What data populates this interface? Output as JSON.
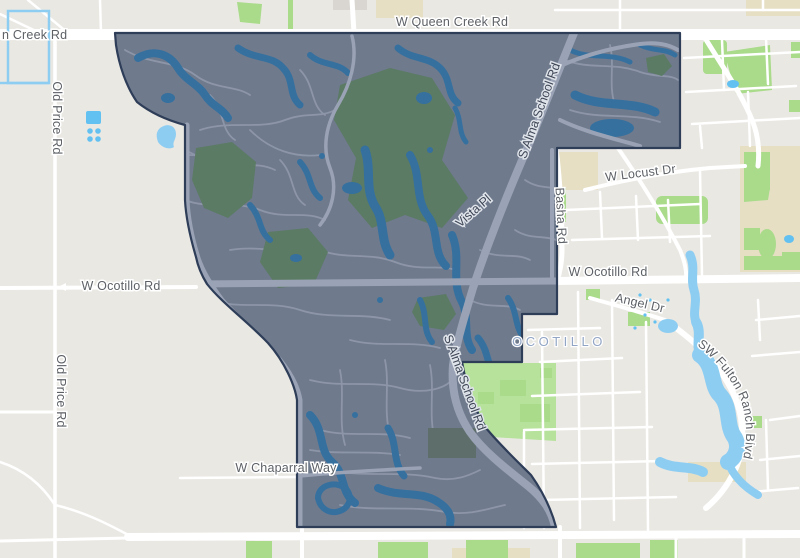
{
  "map": {
    "kind": "street-map-with-boundary-overlay",
    "district_label": "OCOTILLO",
    "road_labels": {
      "queen_creek_partial": "n Creek Rd",
      "queen_creek": "W Queen Creek Rd",
      "old_price_upper": "Old Price Rd",
      "old_price_lower": "Old Price Rd",
      "alma_school_upper": "S Alma School Rd",
      "alma_school_lower": "S Alma School Rd",
      "vista_pl": "Vista Pl",
      "basha": "Basha Rd",
      "locust": "W Locust Dr",
      "ocotillo_west": "W Ocotillo Rd",
      "ocotillo_east": "W Ocotillo Rd",
      "angel": "Angel Dr",
      "fulton_ranch": "SW Fulton Ranch Blvd",
      "chaparral": "W Chaparral Way"
    },
    "colors": {
      "background": "#eae8e3",
      "road": "#ffffff",
      "park": "#a9db8b",
      "park_light": "#b7e29c",
      "school_grounds": "#e6dfc4",
      "water": "#8ecdf2",
      "pool": "#63c1f1",
      "overlay_fill": "#6f7a8d",
      "overlay_street": "#8d96a8",
      "overlay_major_road": "#9aa3b5",
      "overlay_water": "#35709f",
      "overlay_park": "#5b7b64",
      "overlay_border": "#2e3d58",
      "road_label": "#5d6166",
      "district_label": "#92a5c5"
    }
  }
}
